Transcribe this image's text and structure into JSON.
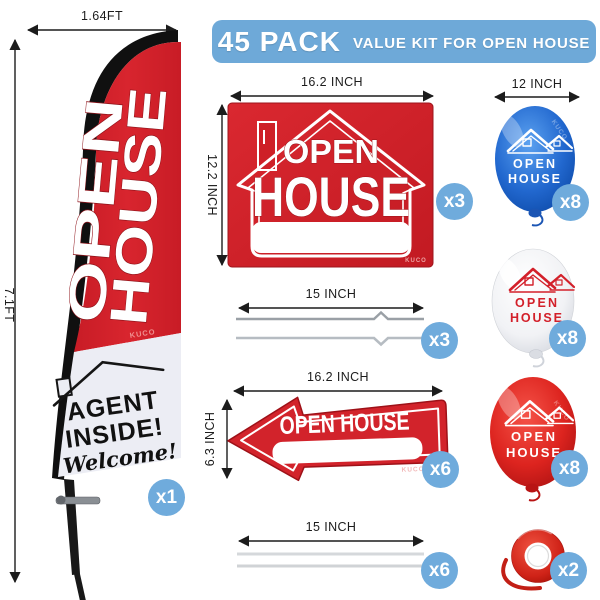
{
  "brand_watermark": "KUCO",
  "banner": {
    "pack_count": "45 PACK",
    "subtitle": "VALUE KIT FOR OPEN HOUSE",
    "bg_color": "#6ea9d8"
  },
  "flag": {
    "width_label": "1.64FT",
    "height_label": "7.1FT",
    "flag_line1": "OPEN",
    "flag_line2": "HOUSE",
    "agent_line1": "AGENT",
    "agent_line2": "INSIDE!",
    "welcome_text": "Welcome!",
    "qty": "x1"
  },
  "house_sign": {
    "width_label": "16.2 INCH",
    "height_label": "12.2 INCH",
    "line1": "OPEN",
    "line2": "HOUSE",
    "qty": "x3"
  },
  "wire_stakes": {
    "length_label": "15 INCH",
    "qty": "x3"
  },
  "arrow_sign": {
    "width_label": "16.2 INCH",
    "height_label": "6.3 INCH",
    "text": "OPEN HOUSE",
    "qty": "x6"
  },
  "straight_stakes": {
    "length_label": "15 INCH",
    "qty": "x6"
  },
  "balloons": {
    "size_label": "12 INCH",
    "items": [
      {
        "color": "blue",
        "line1": "OPEN",
        "line2": "HOUSE",
        "qty": "x8"
      },
      {
        "color": "white",
        "line1": "OPEN",
        "line2": "HOUSE",
        "qty": "x8"
      },
      {
        "color": "red",
        "line1": "OPEN",
        "line2": "HOUSE",
        "qty": "x8"
      }
    ]
  },
  "ribbon": {
    "qty": "x2"
  },
  "colors": {
    "banner_blue": "#6ea9d8",
    "badge_blue": "#6fabdc",
    "flag_red": "#d2202a",
    "sign_red": "#ce2027",
    "balloon_blue": "#2268cf",
    "balloon_red": "#d8231f",
    "ribbon_red": "#da2b1f"
  }
}
